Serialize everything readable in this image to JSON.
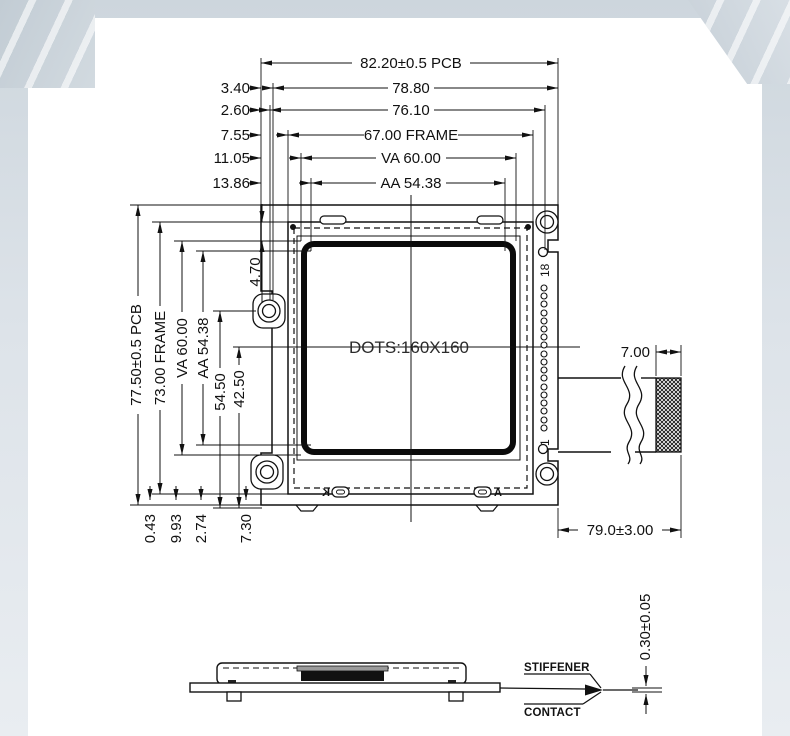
{
  "theme": {
    "band_color": "#cdd6dd",
    "paper": "#ffffff",
    "line_color": "#111111"
  },
  "drawing": {
    "display": {
      "dots_label": "DOTS:160X160"
    },
    "top_dims": {
      "pcb_width": "82.20±0.5 PCB",
      "d788": "78.80",
      "d761": "76.10",
      "frame_width": "67.00 FRAME",
      "va_width": "VA 60.00",
      "aa_width": "AA 54.38"
    },
    "top_offsets": {
      "o1": "3.40",
      "o2": "2.60",
      "o3": "7.55",
      "o4": "11.05",
      "o5": "13.86"
    },
    "left_dims": {
      "pcb_height": "77.50±0.5 PCB",
      "frame_height": "73.00 FRAME",
      "va_height": "VA 60.00",
      "aa_height": "AA 54.38",
      "d545": "54.50",
      "d425": "42.50",
      "d470": "4.70"
    },
    "bottom_offsets": {
      "o1": "0.43",
      "o2": "9.93",
      "o3": "2.74",
      "o4": "7.30"
    },
    "connector": {
      "pin_top": "18",
      "pin_bottom": "1",
      "contact_width": "7.00",
      "tail_length": "79.0±3.00"
    },
    "backlight": {
      "cathode": "K",
      "anode": "A"
    },
    "side_view": {
      "stiffener": "STIFFENER",
      "contact": "CONTACT",
      "thickness": "0.30±0.05"
    }
  }
}
